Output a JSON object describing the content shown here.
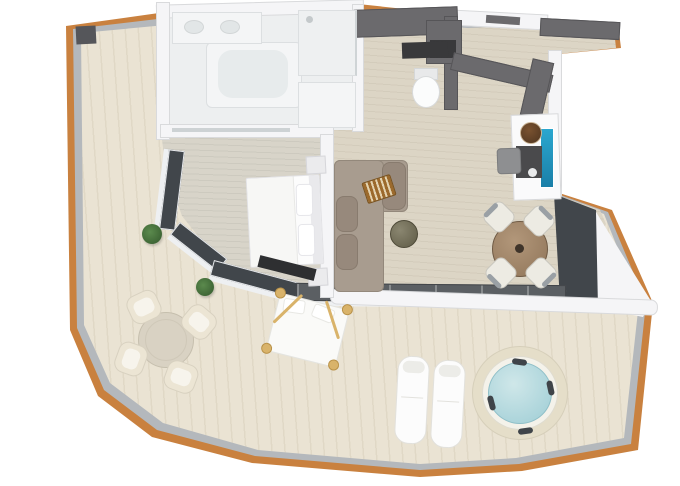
{
  "meta": {
    "type": "3d-floor-plan-render",
    "background": "#ffffff"
  },
  "palette": {
    "trim": "#c9813f",
    "rail": "#b4b8bc",
    "deck": "#eae3d3",
    "deck_grain": "rgba(139,119,86,0.10)",
    "floor_liv": "#dcd5c5",
    "floor_bed": "#d8d4c9",
    "floor_wc": "#d7d0c0",
    "floor_bath": "#edeff0",
    "wall_white": "#f5f5f7",
    "wall_edge": "#d9dadc",
    "wall_dark": "#6b6a6d",
    "wall_dark_edge": "#565558",
    "glass": "#41464b",
    "glass_frame": "#e9ebee",
    "threshold": "#5b5f63",
    "sofa": "#a89c8f",
    "sofa_edge": "#93887b",
    "cushion": "#97897c",
    "pillow_stripe_a": "#9c6a2c",
    "pillow_stripe_b": "#e3d3b0",
    "pouf_a": "#8a8670",
    "pouf_b": "#5f5b46",
    "wood_table_a": "#b2977a",
    "wood_table_b": "#8f7458",
    "chair_seat": "#edebe3",
    "chair_back": "#9aa0a5",
    "stone": "#d9d2c3",
    "cream_chair": "#ece5d4",
    "cream_edge": "#d8d1c0",
    "gold": "#d9b36a",
    "white_furn": "#fcfcfc",
    "furn_edge": "#e2e2e5",
    "water_a": "#cfe7e9",
    "water_b": "#9ecdd5",
    "water_edge": "#8fbfc8",
    "tub_surround": "#e5dec9",
    "headrest": "#3f4449",
    "plant_a": "#5b8a4d",
    "plant_b": "#33582c",
    "counter_dark": "#39393b",
    "blue_a": "#2ba7cf",
    "blue_b": "#1a7fa8",
    "stool_a": "#7a5230",
    "stool_b": "#4e3520",
    "tv_dark": "#2e2f31"
  },
  "rooms": {
    "balcony": {
      "label": "Wrap-around balcony",
      "items": {
        "deck": "whitewashed wood deck",
        "trim": "wood fascia trim",
        "railing": "glass railing",
        "table": "round outdoor dining table",
        "chairs": "4 cream tub chairs",
        "daybed": "canopy daybed",
        "loungers": "2 sun loungers",
        "hottub": "round hot tub",
        "plants": "potted plants",
        "partition": "privacy partition"
      }
    },
    "bathroom": {
      "label": "Bathroom",
      "items": {
        "tub": "bathtub",
        "vanity": "double-sink vanity",
        "shower": "walk-in shower",
        "counter": "counter"
      }
    },
    "wc": {
      "label": "WC",
      "items": {
        "toilet": "toilet",
        "counter": "dark counter"
      }
    },
    "entry": {
      "label": "Entry hall",
      "items": {
        "door": "entrance door",
        "wardrobe": "dark wardrobe",
        "console": "minibar console",
        "panel": "blue backlit panel",
        "bowl": "round wooden bowl",
        "chair": "desk chair"
      }
    },
    "bedroom": {
      "label": "Bedroom",
      "items": {
        "bed": "king bed",
        "nightstands": "nightstands",
        "tv": "TV unit",
        "doors": "curved glass doors"
      }
    },
    "living": {
      "label": "Living and dining room",
      "items": {
        "sofa": "L-shaped sofa",
        "pillows": "striped accent pillows",
        "pouf": "round coffee table",
        "dtable": "round dining table",
        "dchairs": "4 dining chairs",
        "glasswall": "floor-to-ceiling glass wall",
        "slider": "sliding glass doors"
      }
    }
  }
}
